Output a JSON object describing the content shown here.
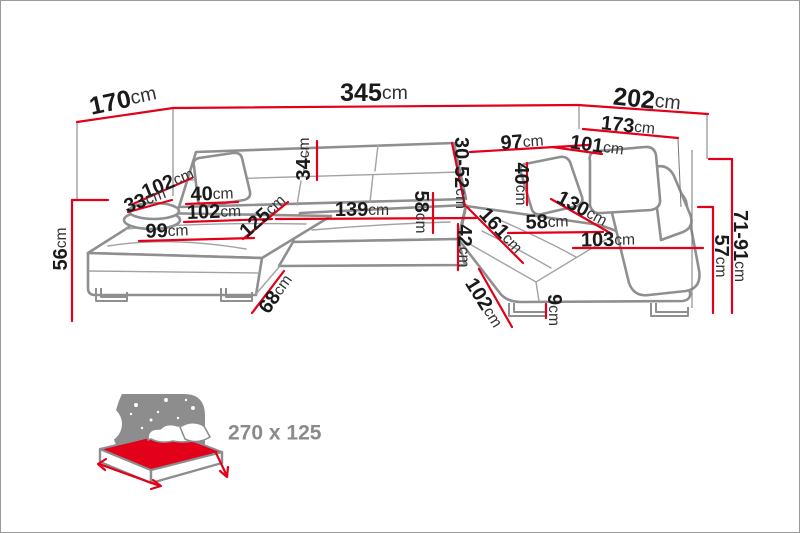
{
  "colors": {
    "dimension_red": "#e2001a",
    "sofa_outline_gray": "#8f8f8f",
    "text_black": "#1a1a1a",
    "icon_gray": "#8d8d8d",
    "label_gray": "#8a8a8a"
  },
  "diagram": {
    "subject": "corner-sofa-dimension-diagram",
    "measurements": [
      {
        "name": "left-side-total-depth",
        "value": "170",
        "unit": "cm"
      },
      {
        "name": "total-width",
        "value": "345",
        "unit": "cm"
      },
      {
        "name": "right-side-total-depth",
        "value": "202",
        "unit": "cm"
      },
      {
        "name": "right-side-outer-length",
        "value": "173",
        "unit": "cm"
      },
      {
        "name": "back-section-width",
        "value": "97",
        "unit": "cm"
      },
      {
        "name": "right-back-length",
        "value": "101",
        "unit": "cm"
      },
      {
        "name": "backrest-height-range",
        "value": "30-52",
        "unit": "cm"
      },
      {
        "name": "headrest-flap-height",
        "value": "34",
        "unit": "cm"
      },
      {
        "name": "left-arm-section-length",
        "value": "102",
        "unit": "cm"
      },
      {
        "name": "left-bolster-pillow",
        "value": "33",
        "unit": "cm"
      },
      {
        "name": "left-pillow",
        "value": "40",
        "unit": "cm"
      },
      {
        "name": "left-seat-length",
        "value": "102",
        "unit": "cm"
      },
      {
        "name": "left-chaise-depth",
        "value": "125",
        "unit": "cm"
      },
      {
        "name": "center-seat-width",
        "value": "139",
        "unit": "cm"
      },
      {
        "name": "left-chaise-seat-width",
        "value": "99",
        "unit": "cm"
      },
      {
        "name": "seat-frame-height",
        "value": "56",
        "unit": "cm"
      },
      {
        "name": "corner-edge-length",
        "value": "68",
        "unit": "cm"
      },
      {
        "name": "center-seat-depth",
        "value": "58",
        "unit": "cm"
      },
      {
        "name": "front-panel-height",
        "value": "42",
        "unit": "cm"
      },
      {
        "name": "right-chaise-length",
        "value": "161",
        "unit": "cm"
      },
      {
        "name": "right-chaise-edge-length",
        "value": "102",
        "unit": "cm"
      },
      {
        "name": "right-pillow",
        "value": "40",
        "unit": "cm"
      },
      {
        "name": "right-chaise-diagonal",
        "value": "130",
        "unit": "cm"
      },
      {
        "name": "right-seat-width",
        "value": "58",
        "unit": "cm"
      },
      {
        "name": "right-seat-length",
        "value": "103",
        "unit": "cm"
      },
      {
        "name": "adjustable-headrest-height",
        "value": "71-91",
        "unit": "cm"
      },
      {
        "name": "armrest-height",
        "value": "57",
        "unit": "cm"
      },
      {
        "name": "leg-height",
        "value": "9",
        "unit": "cm"
      }
    ]
  },
  "sleeping_area": {
    "size": "270 x 125"
  }
}
